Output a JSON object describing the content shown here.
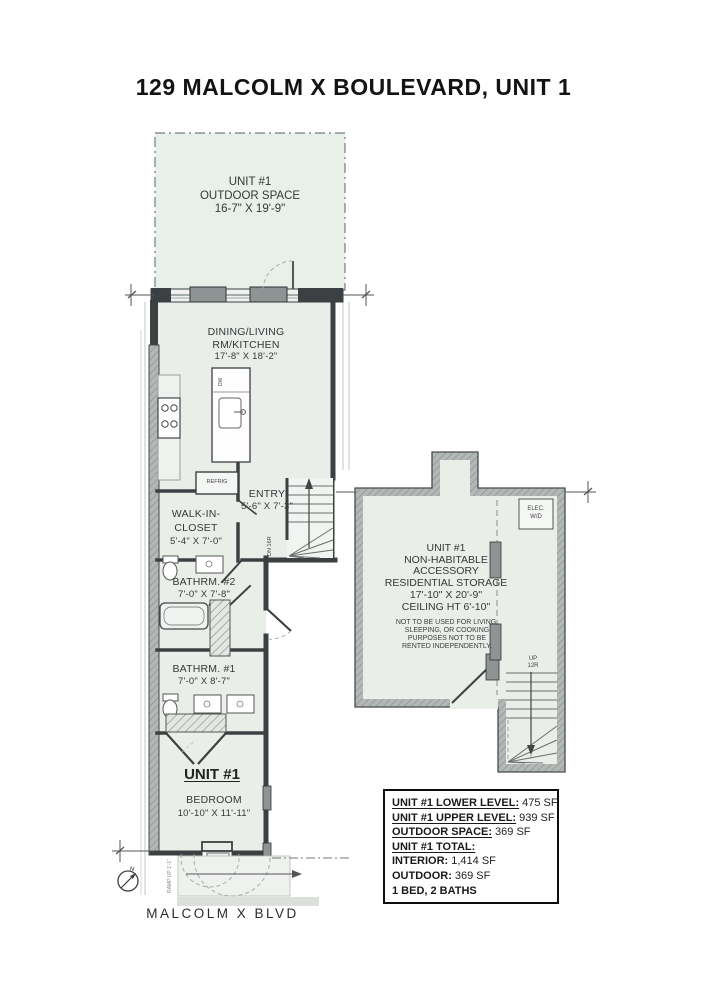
{
  "title": "129 MALCOLM X BOULEVARD, UNIT 1",
  "street_label": "MALCOLM X BLVD",
  "compass": {
    "letter": "N"
  },
  "outdoor_space": {
    "line1": "UNIT #1",
    "line2": "OUTDOOR SPACE",
    "line3": "16-7\" X 19'-9\""
  },
  "dining": {
    "line1": "DINING/LIVING",
    "line2": "RM/KITCHEN",
    "line3": "17'-8\" X  18'-2\""
  },
  "entry": {
    "line1": "ENTRY",
    "line2": "5'-6\" X 7'-3\""
  },
  "closet": {
    "line1": "WALK-IN-",
    "line2": "CLOSET",
    "line3": "5'-4\" X 7'-0\""
  },
  "bath2": {
    "line1": "BATHRM. #2",
    "line2": "7'-0\" X  7'-8\""
  },
  "bath1": {
    "line1": "BATHRM. #1",
    "line2": "7'-0\" X  8'-7\""
  },
  "bedroom": {
    "unit": "UNIT #1",
    "line1": "BEDROOM",
    "line2": "10'-10\" X  11'-11\""
  },
  "storage": {
    "line1": "UNIT #1",
    "line2": "NON-HABITABLE",
    "line3": "ACCESSORY",
    "line4": "RESIDENTIAL STORAGE",
    "line5": "17'-10\" X 20'-9\"",
    "line6": "CEILING HT 6'-10\"",
    "note1": "NOT TO BE USED FOR LIVING,",
    "note2": "SLEEPING, OR COOKING",
    "note3": "PURPOSES NOT TO BE",
    "note4": "RENTED INDEPENDENTLY."
  },
  "labels": {
    "refrig": "REFRIG",
    "dw": "DW",
    "elec1": "ELEC.",
    "elec2": "W/D",
    "up1": "UP",
    "up2": "12R",
    "dn": "DN 16R",
    "ramp": "RAMP UP 1'-1\""
  },
  "colors": {
    "room_fill": "#e9eee9",
    "wall_dark": "#3c4042",
    "window_gray": "#8e9394",
    "storage_wall": "#b3b8b6"
  },
  "summary": {
    "rows": [
      {
        "label": "UNIT #1 LOWER LEVEL:",
        "value": "475 SF"
      },
      {
        "label": "UNIT #1 UPPER LEVEL:",
        "value": "939 SF"
      },
      {
        "label": "OUTDOOR SPACE:",
        "value": "369 SF"
      },
      {
        "label": "UNIT #1 TOTAL:",
        "value": ""
      },
      {
        "label": "INTERIOR:",
        "value": "1,414 SF"
      },
      {
        "label": "OUTDOOR:",
        "value": "369 SF"
      },
      {
        "label": "1 BED, 2 BATHS",
        "value": ""
      }
    ]
  }
}
